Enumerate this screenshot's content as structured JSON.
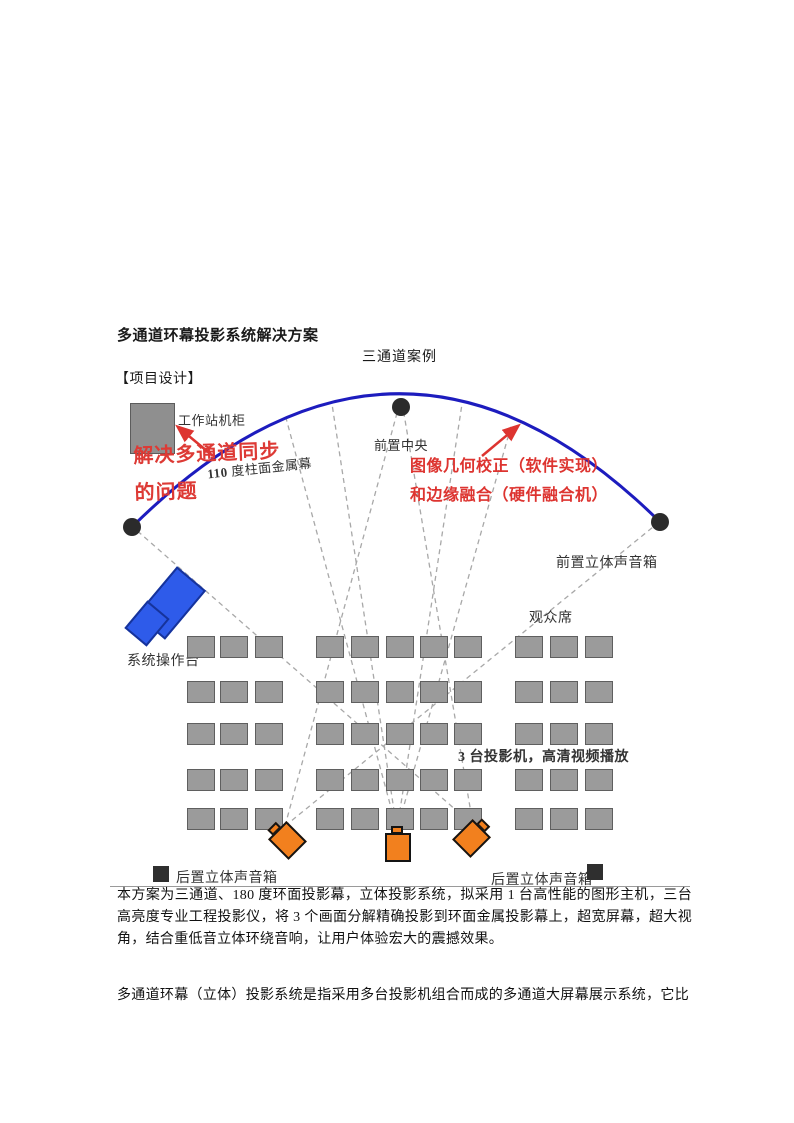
{
  "page": {
    "title": "多通道环幕投影系统解决方案",
    "diagram_caption": "三通道案例",
    "section_label": "【项目设计】",
    "paragraphs": [
      "本方案为三通道、180 度环面投影幕，立体投影系统，拟采用 1 台高性能的图形主机，三台高亮度专业工程投影仪，将 3 个画面分解精确投影到环面金属投影幕上，超宽屏幕，超大视角，结合重低音立体环绕音响，让用户体验宏大的震撼效果。",
      "多通道环幕（立体）投影系统是指采用多台投影机组合而成的多通道大屏幕展示系统，它比"
    ]
  },
  "diagram": {
    "labels": {
      "workstation": "工作站机柜",
      "screen_prefix": "110",
      "screen_rest": " 度柱面金属幕",
      "front_center": "前置中央",
      "front_speaker": "前置立体声音箱",
      "audience": "观众席",
      "console": "系统操作台",
      "projectors": "3 台投影机，高清视频播放",
      "rear_speaker_left": "后置立体声音箱",
      "rear_speaker_right": "后置立体声音箱"
    },
    "annotations": {
      "sync_line1": "解决多通道同步",
      "sync_line2": "的问题",
      "correction_line1": "图像几何校正（软件实现）",
      "correction_line2": "和边缘融合（硬件融合机）"
    },
    "colors": {
      "screen_arc_blue": "#1d1cbe",
      "annotation_red": "#dd3430",
      "console_blue": "#2e5bea",
      "projector_orange": "#f2801e",
      "seat_gray": "#9b9b9b",
      "dot_black": "#2b2b2b",
      "beam_gray": "#a8a8a8"
    }
  }
}
